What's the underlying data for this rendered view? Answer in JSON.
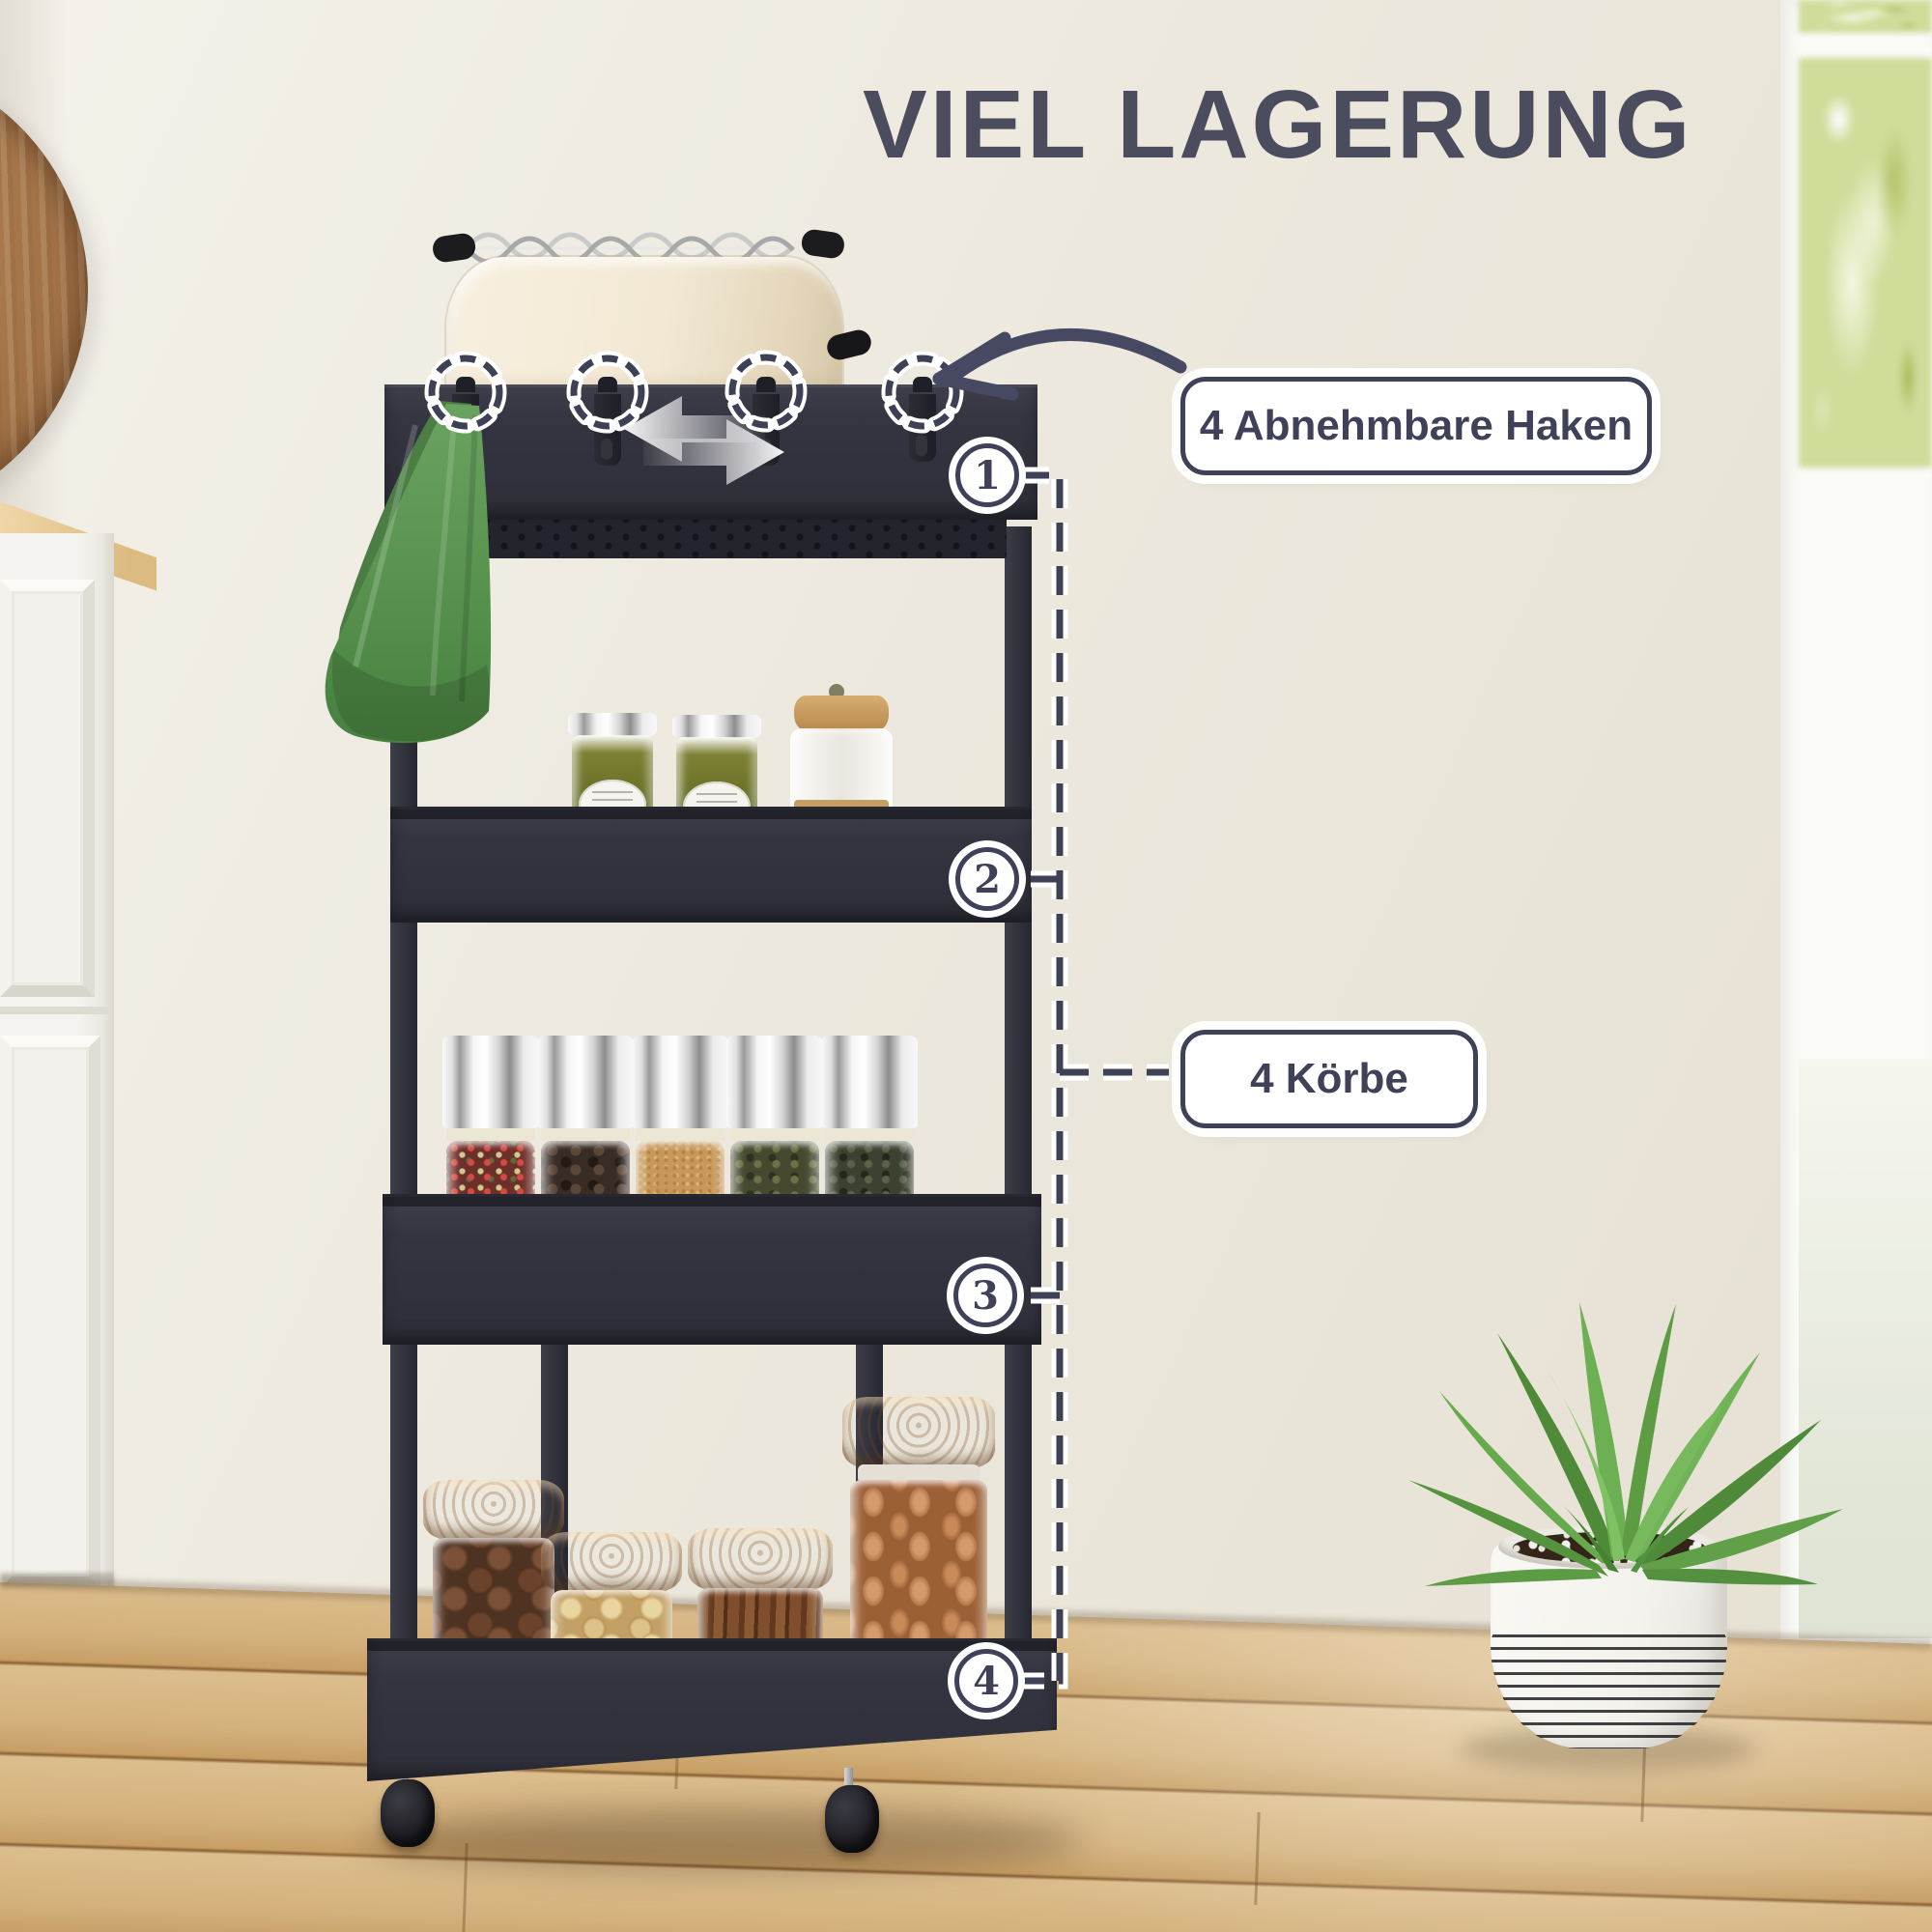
{
  "title": "VIEL LAGERUNG",
  "callouts": {
    "hooks_label": "4 Abnehmbare Haken",
    "baskets_label": "4 Körbe"
  },
  "markers": [
    {
      "number": "1"
    },
    {
      "number": "2"
    },
    {
      "number": "3"
    },
    {
      "number": "4"
    }
  ],
  "icons": {
    "curved_arrow": "hand-drawn arrow pointing at removable hooks",
    "slide_arrows": "white left-right arrows showing hooks slide",
    "hook_ring": "dashed circle highlight around each hook",
    "leader_line": "dashed leader line linking numbered baskets"
  },
  "colors": {
    "accent_navy": "#3f4158",
    "title_color": "#4b4c5e",
    "cart_dark": "#32333d",
    "towel_green": "#5f9457",
    "floor_wood": "#d2ab74",
    "wall": "#ece8dd",
    "plant_green": "#61a048",
    "callout_bg": "#ffffff"
  }
}
